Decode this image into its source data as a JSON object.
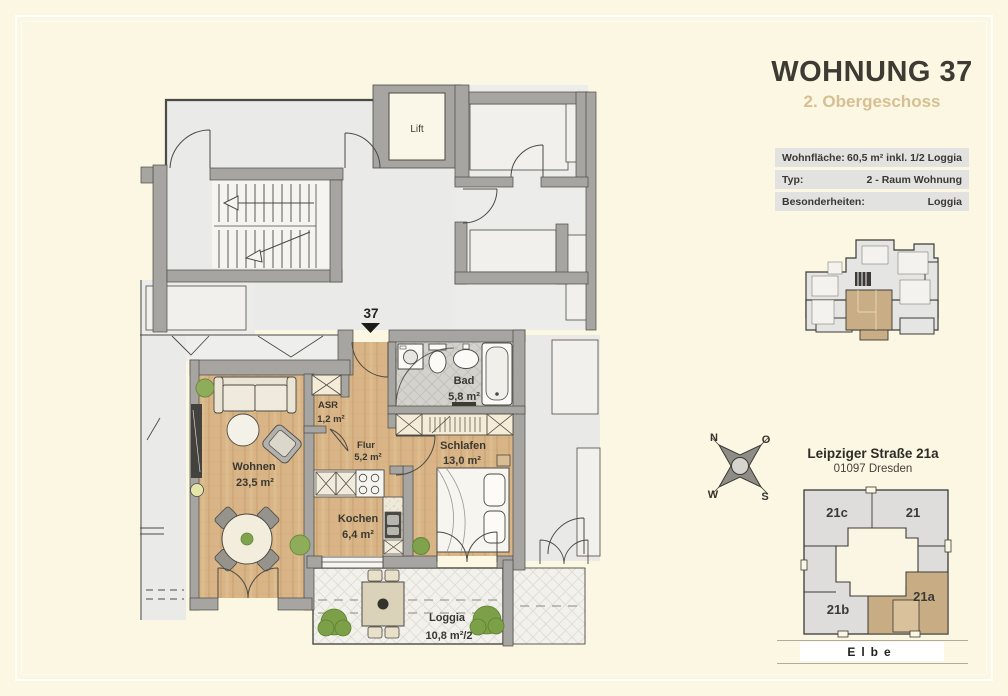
{
  "header": {
    "title": "WOHNUNG 37",
    "subtitle": "2. Obergeschoss"
  },
  "info_table": {
    "rows": [
      {
        "label": "Wohnfläche:",
        "value": "60,5 m² inkl. 1/2 Loggia"
      },
      {
        "label": "Typ:",
        "value": "2 - Raum Wohnung"
      },
      {
        "label": "Besonderheiten:",
        "value": "Loggia"
      }
    ]
  },
  "floor_plan": {
    "unit_marker": "37",
    "lift_label": "Lift",
    "rooms": [
      {
        "id": "wohnen",
        "name": "Wohnen",
        "area": "23,5 m²"
      },
      {
        "id": "kochen",
        "name": "Kochen",
        "area": "6,4 m²"
      },
      {
        "id": "flur",
        "name": "Flur",
        "area": "5,2 m²"
      },
      {
        "id": "asr",
        "name": "ASR",
        "area": "1,2 m²"
      },
      {
        "id": "bad",
        "name": "Bad",
        "area": "5,8 m²"
      },
      {
        "id": "schlafen",
        "name": "Schlafen",
        "area": "13,0 m²"
      },
      {
        "id": "loggia",
        "name": "Loggia",
        "area": "10,8 m²/2"
      }
    ]
  },
  "compass": {
    "north": "N",
    "east": "O",
    "south": "S",
    "west": "W"
  },
  "address": {
    "street": "Leipziger Straße 21a",
    "city": "01097 Dresden"
  },
  "site_plan": {
    "buildings": [
      {
        "label": "21c"
      },
      {
        "label": "21"
      },
      {
        "label": "21b"
      },
      {
        "label": "21a",
        "highlighted": true
      }
    ],
    "river_label": "Elbe"
  },
  "colors": {
    "background": "#fcf7e2",
    "wall": "#a7a5a1",
    "wood": "#d7b284",
    "highlight": "#c9ae85",
    "subtitle_accent": "#d5c094",
    "label_text": "#3a3832"
  }
}
